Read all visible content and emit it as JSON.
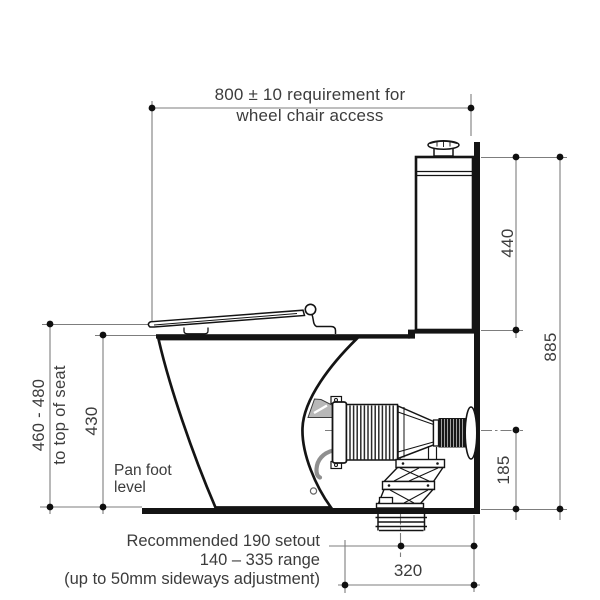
{
  "diagram": {
    "colors": {
      "background": "#ffffff",
      "outline": "#141414",
      "dimension_line": "#7d7d7d",
      "text": "#3c3c3c",
      "bracket_gray": "#b8b8b8"
    },
    "dim_800": {
      "line1": "800 ± 10 requirement for",
      "line2": "wheel chair access"
    },
    "dim_440": "440",
    "dim_885": "885",
    "dim_185": "185",
    "dim_430": "430",
    "seat_height": {
      "range": "460 - 480",
      "note": "to top of seat"
    },
    "pan_foot_label": {
      "line1": "Pan foot",
      "line2": "level"
    },
    "setout_notes": {
      "line1": "Recommended 190 setout",
      "line2": "140 – 335 range",
      "line3": "(up to 50mm sideways adjustment)"
    },
    "dim_320": "320"
  }
}
